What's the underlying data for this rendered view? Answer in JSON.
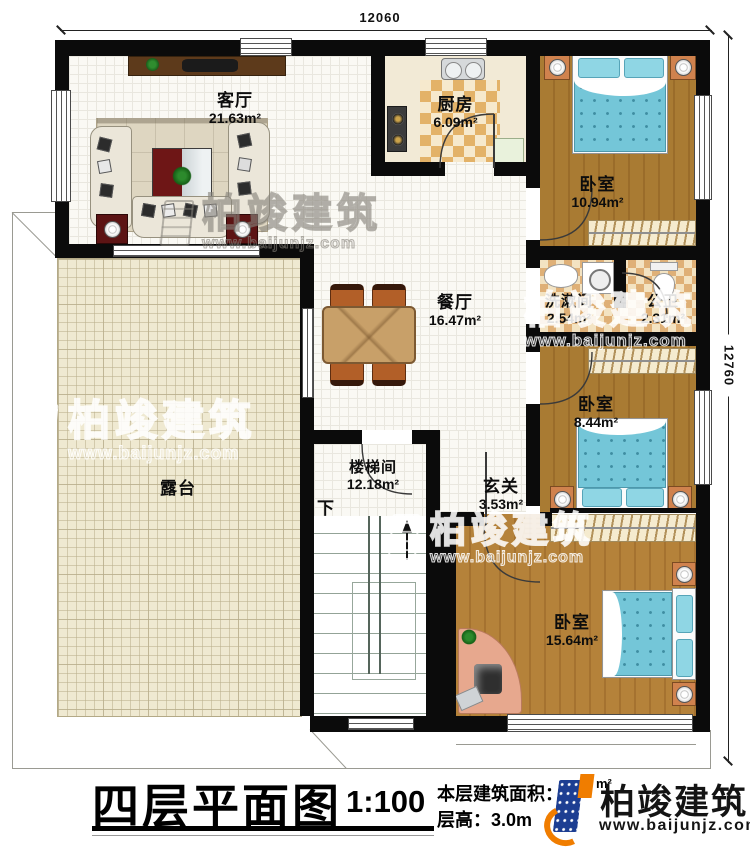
{
  "plan": {
    "dim_top": "12060",
    "dim_right": "12760",
    "rooms": {
      "living": {
        "name": "客厅",
        "area": "21.63m²"
      },
      "kitchen": {
        "name": "厨房",
        "area": "6.09m²"
      },
      "bedroom1": {
        "name": "卧室",
        "area": "10.94m²"
      },
      "dining": {
        "name": "餐厅",
        "area": "16.47m²"
      },
      "washroom": {
        "name": "洗漱间",
        "area": "2.54m²"
      },
      "toilet": {
        "name": "公卫",
        "area": "2.31m²"
      },
      "bedroom2": {
        "name": "卧室",
        "area": "8.44m²"
      },
      "terrace": {
        "name": "露台"
      },
      "stairs": {
        "name": "楼梯间",
        "area": "12.18m²",
        "down_label": "下"
      },
      "foyer": {
        "name": "玄关",
        "area": "3.53m²"
      },
      "bedroom3": {
        "name": "卧室",
        "area": "15.64m²"
      }
    }
  },
  "footer": {
    "title": "四层平面图",
    "scale": "1:100",
    "area_label": "本层建筑面积：",
    "area_value": "22",
    "area_unit": "m²",
    "height_label": "层高：",
    "height_value": "3.0m"
  },
  "brand": {
    "name": "柏竣建筑",
    "url": "www.baijunjz.com"
  },
  "colors": {
    "wall": "#0b0b0b",
    "brand_blue": "#1d3e92",
    "brand_orange": "#f07d00"
  }
}
